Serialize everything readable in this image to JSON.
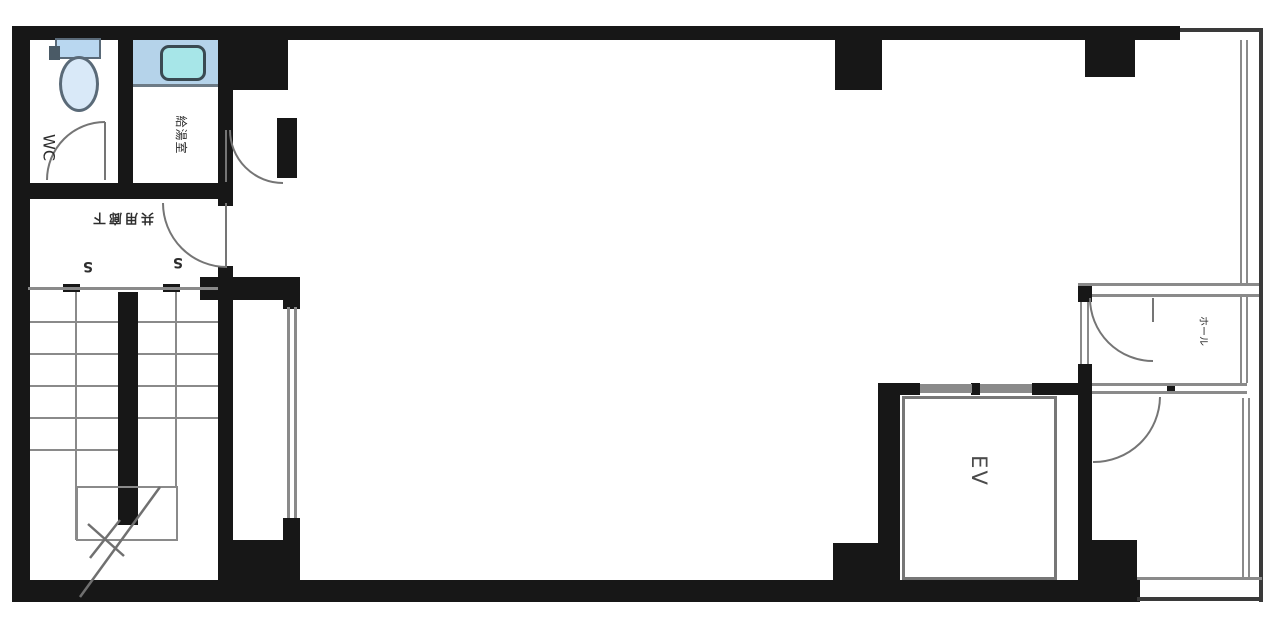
{
  "drawing": {
    "kind": "building floor plan",
    "style": "scanned black-and-white Japanese floor plan with blue plumbing fixtures"
  },
  "labels": {
    "wc": "WC",
    "kitchenette": "給湯室",
    "corridor": "共用廊下",
    "stair_mark_left": "S",
    "stair_mark_right": "S",
    "hall": "ホール",
    "elevator": "EV"
  },
  "colors": {
    "wall": "#171717",
    "thin_line": "#8a8a8a",
    "toilet_tank_blue": "#b9d7f0",
    "toilet_bowl_blue": "#d9e9f8",
    "counter_blue": "#b5d3ea",
    "sink_teal": "#a7e6e8"
  }
}
